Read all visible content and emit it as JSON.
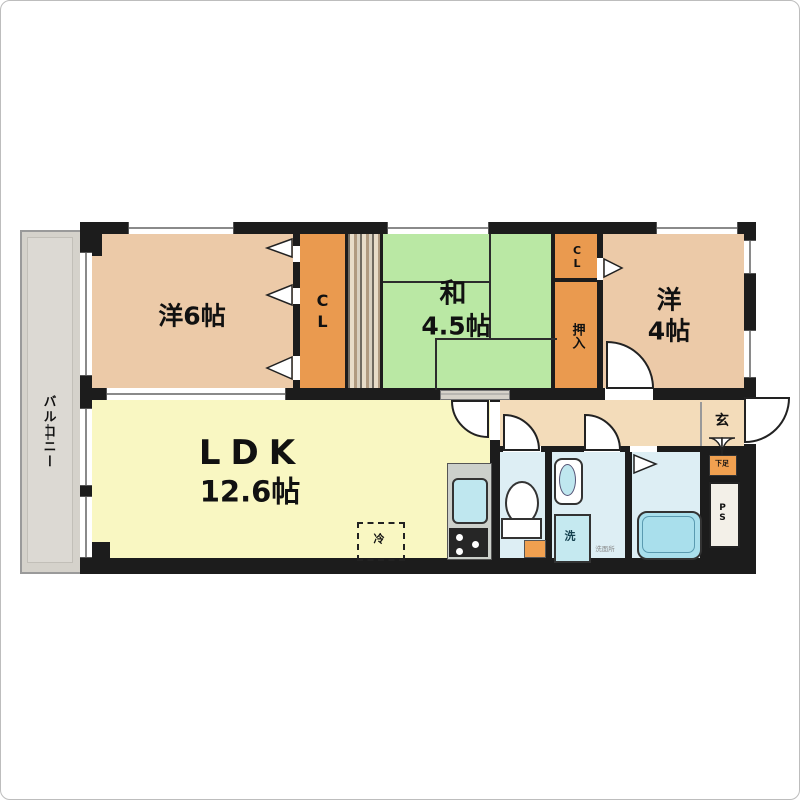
{
  "floorplan": {
    "labels": {
      "balcony": "バルコニー",
      "western6": "洋6帖",
      "closet1": "CL",
      "japanese_line1": "和",
      "japanese_line2": "4.5帖",
      "oshiire": "押入",
      "closet2": "CL",
      "western4_line1": "洋",
      "western4_line2": "4帖",
      "ldk_line1": "LDK",
      "ldk_line2": "12.6帖",
      "genkan": "玄",
      "shoe_cabinet": "下足",
      "pipe_space": "PS",
      "washer_pan": "洗",
      "washroom_small": "洗面所",
      "refrigerator": "冷"
    },
    "colors": {
      "wall": "#1c1c1c",
      "western_room": "#eccaa8",
      "tatami_green": "#bae8a4",
      "ldk_yellow": "#f9f7c2",
      "closet_orange": "#ea9a4f",
      "hallway_cream": "#f3dcba",
      "water_blue": "#ddeef4",
      "fixture_blue": "#bfe7ef",
      "balcony_gray": "#d5d2cb"
    }
  }
}
